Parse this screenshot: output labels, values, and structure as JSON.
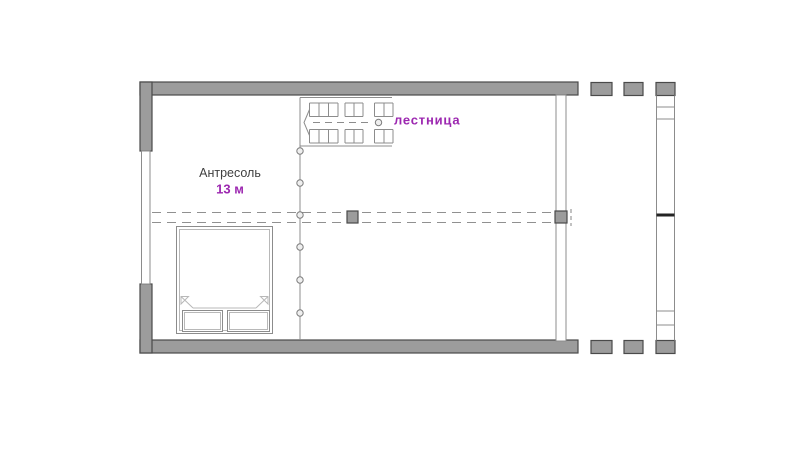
{
  "plan": {
    "labels": {
      "room_name": "Антресоль",
      "room_area": "13 м",
      "stair_label": "лестница"
    },
    "colors": {
      "wall_fill": "#9c9c9c",
      "wall_stroke": "#4a4a4a",
      "line": "#8c8c8c",
      "dark_band": "#242424",
      "text_dark": "#3f3f3f",
      "accent_purple": "#9c27b0"
    }
  }
}
